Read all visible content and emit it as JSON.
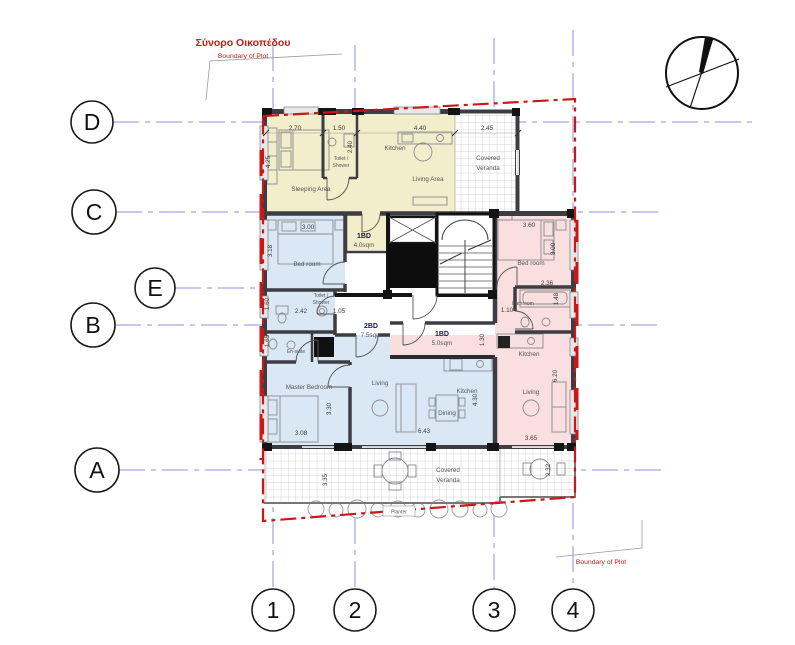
{
  "boundary": {
    "label_greek": "Σύνορο Οικοπέδου",
    "label_english_top": "Boundary of Plot",
    "label_english_bottom": "Boundary of Plot"
  },
  "grid_bubbles": {
    "d": "D",
    "c": "C",
    "e": "E",
    "b": "B",
    "a": "A",
    "n1": "1",
    "n2": "2",
    "n3": "3",
    "n4": "4"
  },
  "unit_yellow": {
    "label": "1BD",
    "area": "4.0sqm",
    "rooms": {
      "sleeping_area": "Sleeping Area",
      "toilet_line1": "Toilet /",
      "toilet_line2": "Shower",
      "kitchen": "Kitchen",
      "living_area": "Living Area",
      "veranda_line1": "Covered",
      "veranda_line2": "Veranda"
    },
    "dims": {
      "top_1": "2.70",
      "top_2": "1.50",
      "top_3": "4.40",
      "top_4": "2.45",
      "left": "4.25",
      "mid": "2.40"
    }
  },
  "unit_blue": {
    "label": "2BD",
    "area": "7.5sqm",
    "rooms": {
      "bedroom": "Bed room",
      "toilet_line1": "Toilet /",
      "toilet_line2": "Shower",
      "ensuite": "En-suite",
      "master_bedroom": "Master Bedroom",
      "living": "Living",
      "dining": "Dining",
      "kitchen": "Kitchen",
      "veranda_line1": "Covered",
      "veranda_line2": "Veranda",
      "planter": "Planter"
    },
    "dims": {
      "bedroom_w": "3.00",
      "bedroom_h": "3.18",
      "toilet_w": "2.42",
      "toilet_side": "1.05",
      "toilet_h": "1.60",
      "ensuite_h": "1.65",
      "master_w": "3.08",
      "master_h": "3.30",
      "living_w": "6.43",
      "kitchen_h": "4.30",
      "veranda_h": "3.35"
    }
  },
  "unit_pink": {
    "label": "1BD",
    "area": "5.0sqm",
    "rooms": {
      "bedroom": "Bed room",
      "bathroom": "Bathroom",
      "kitchen": "Kitchen",
      "living": "Living"
    },
    "dims": {
      "bedroom_w": "3.60",
      "bedroom_h": "3.00",
      "bath_w": "2.36",
      "bath_h": "1.48",
      "hall_w": "1.10",
      "corridor_h": "1.30",
      "living_w": "3.65",
      "living_h": "6.20",
      "veranda_h": "2.32"
    }
  },
  "colors": {
    "unit_yellow": "#f2edca",
    "unit_blue": "#dae8f6",
    "unit_pink": "#f9dfdf",
    "boundary": "#cc1717",
    "grid_line": "#9292de",
    "wall": "#3c3c42"
  }
}
